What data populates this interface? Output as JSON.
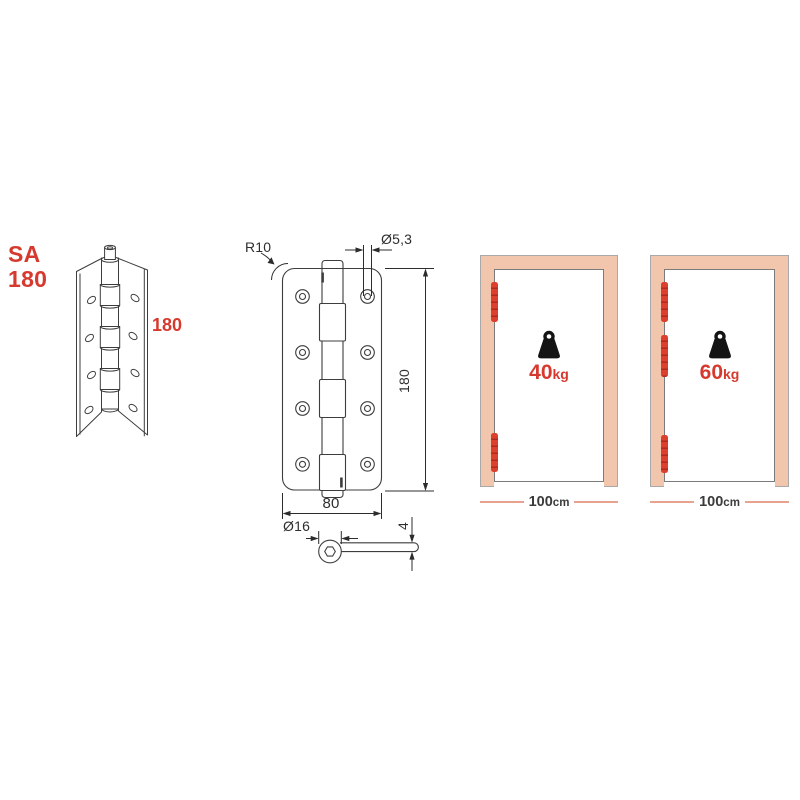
{
  "product": {
    "series": "SA",
    "model": "180",
    "height_label": "180"
  },
  "front_view": {
    "corner_radius": "R10",
    "hole_diameter": "Ø5,3",
    "height": "180",
    "width": "80"
  },
  "side_view": {
    "knuckle_diameter": "Ø16",
    "thickness": "4"
  },
  "doors": [
    {
      "weight_value": "40",
      "weight_unit": "kg",
      "width_value": "100",
      "width_unit": "cm",
      "hinge_count": 2
    },
    {
      "weight_value": "60",
      "weight_unit": "kg",
      "width_value": "100",
      "width_unit": "cm",
      "hinge_count": 3
    }
  ],
  "icons": {
    "weight_icon": "kettlebell-weight-icon",
    "hinge_marker": "red-hinge-segment-bar"
  },
  "colors": {
    "accent_red": "#d63a2e",
    "hinge_red": "#dd3f2e",
    "hinge_red_dark": "#b02a20",
    "frame_peach": "#f2c6ac",
    "drawing_line": "#3d3d3d",
    "dimension_line_salmon": "#e7a390"
  }
}
